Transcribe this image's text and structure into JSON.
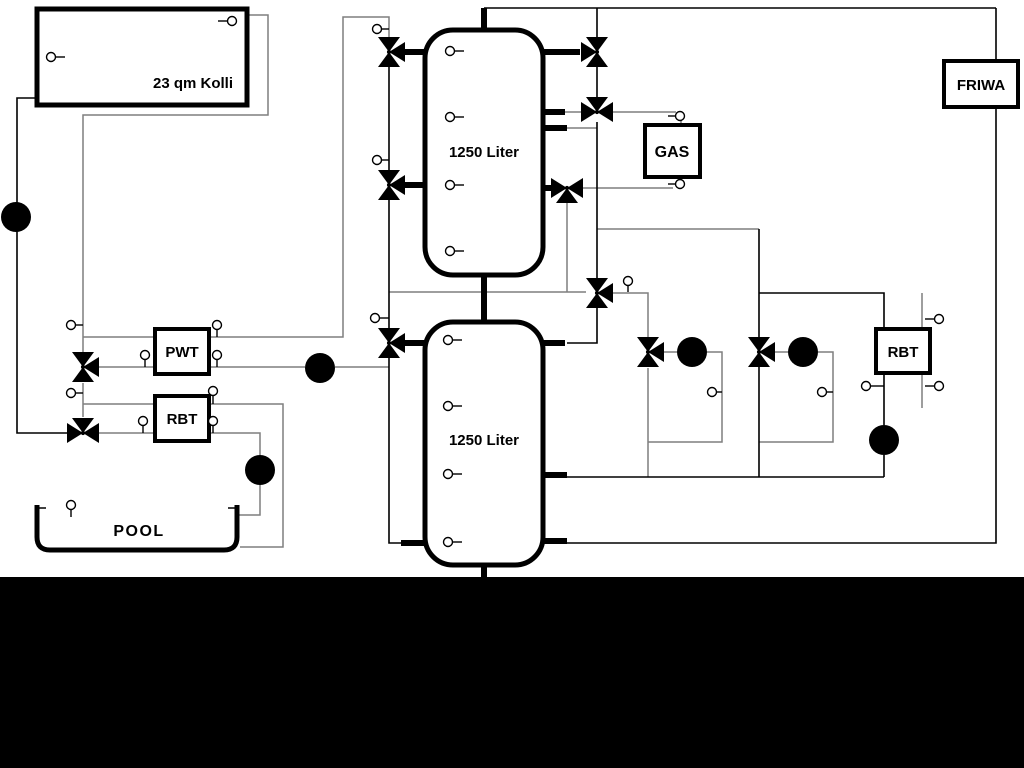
{
  "diagram": {
    "title_hint": "heating/solar hydraulic schematic",
    "labels": {
      "collector": "23 qm Kolli",
      "tank_upper": "1250 Liter",
      "tank_lower": "1250 Liter",
      "gas": "GAS",
      "friwa": "FRIWA",
      "pwt": "PWT",
      "rbt_left": "RBT",
      "rbt_right": "RBT",
      "pool": "POOL"
    },
    "colors": {
      "background": "#ffffff",
      "pipe_gray": "#7f7f7f",
      "pipe_black": "#000000",
      "bottom_bar": "#000000",
      "symbol_fill": "#ffffff"
    },
    "components": {
      "storage_tanks": 2,
      "tank_capacity_each": "1250 Liter",
      "collector_area": "23 qm",
      "three_way_valves": 11,
      "pumps": 6,
      "temperature_sensors": 30,
      "heat_exchangers": [
        "PWT",
        "RBT",
        "RBT"
      ],
      "heat_sources": [
        "23 qm Kolli",
        "GAS"
      ],
      "consumers": [
        "FRIWA",
        "POOL"
      ]
    }
  }
}
